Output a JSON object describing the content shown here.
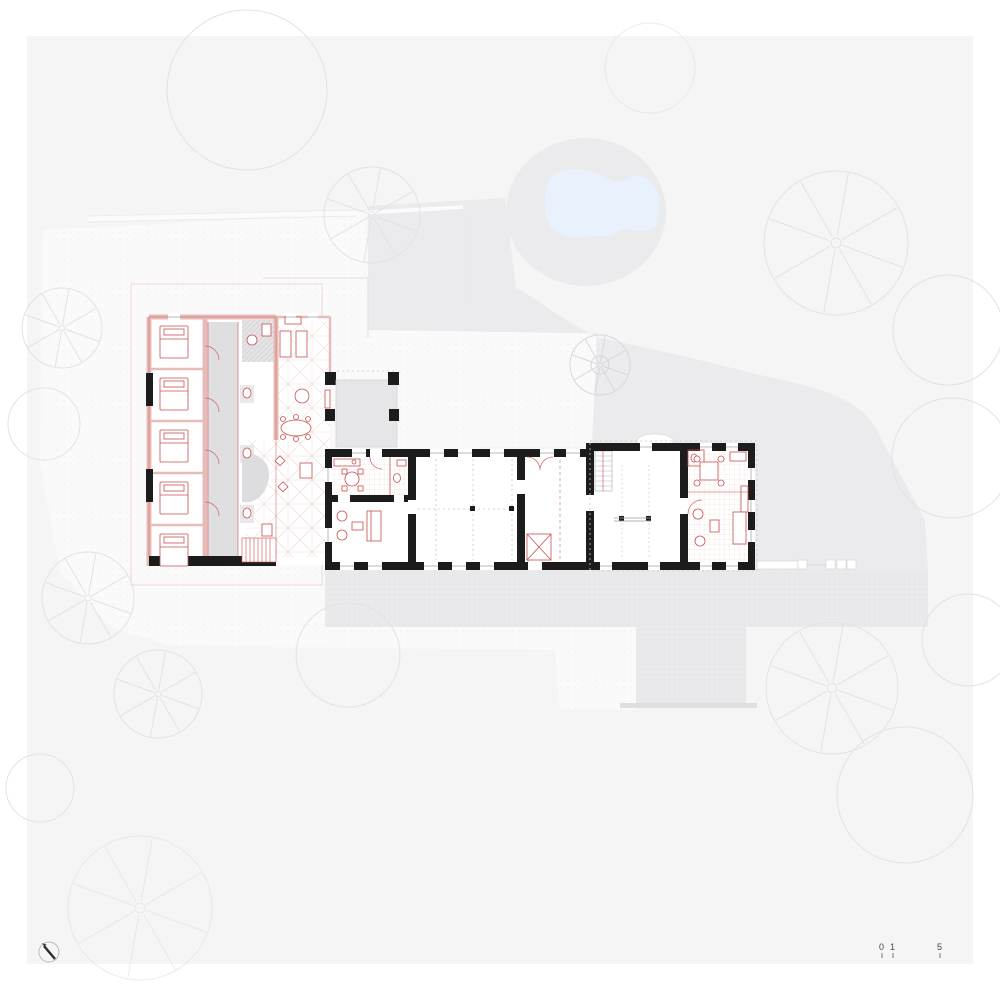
{
  "document": {
    "kind": "architectural-site-and-floor-plan",
    "visible_text": [
      "0",
      "1",
      "5"
    ]
  },
  "colors": {
    "canvas": "#f5f5f6",
    "site_gravel": "#fafafa",
    "lawn": "#ebebed",
    "paving": "#eaeaec",
    "pool_water": "#e9f2fc",
    "pool_deck": "#ebebed",
    "walls_black": "#1c1c1c",
    "annotation_red": "#c85050",
    "annotation_pink": "#e7bcb8",
    "floor_pink": "#f2d2d0",
    "corridor_gray": "#dfdfe1",
    "tree_line": "#e2e2e6",
    "fence_white": "#fbfbfb"
  },
  "scale_bar": {
    "labels": [
      "0",
      "1",
      "5"
    ]
  }
}
